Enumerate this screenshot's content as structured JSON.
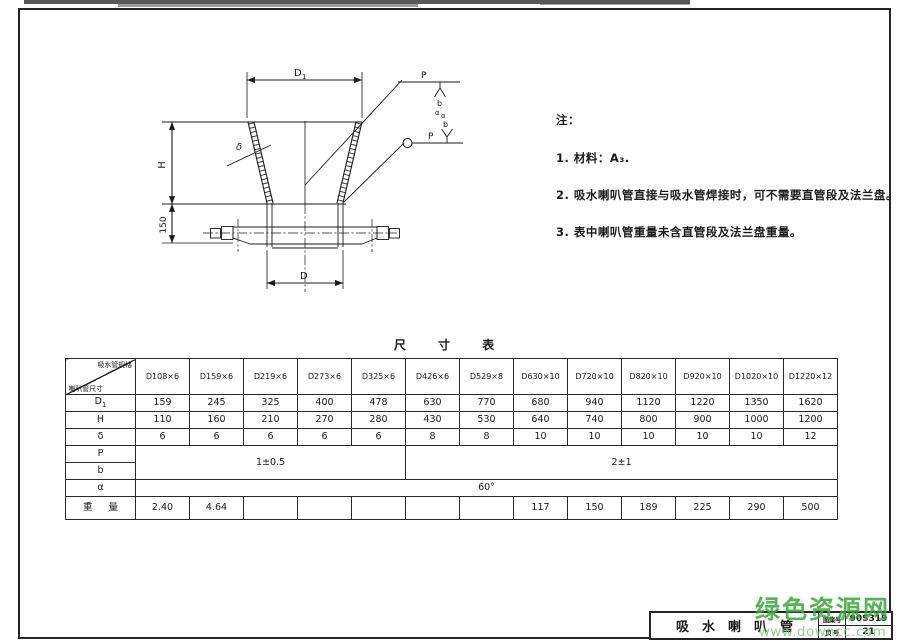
{
  "sheet": {
    "drawing_title": "吸水喇叭管",
    "atlas_label": "图集号",
    "atlas_no": "90S319",
    "page_label": "页 号",
    "page_no": "21"
  },
  "watermark": {
    "line1": "绿色资源网",
    "line2": "www.downcc.com"
  },
  "notes": {
    "heading": "注：",
    "items": [
      "1. 材料：A₃.",
      "2. 吸水喇叭管直接与吸水管焊接时，可不需要直管段及法兰盘。",
      "3. 表中喇叭管重量未含直管段及法兰盘重量。"
    ]
  },
  "drawing": {
    "labels": {
      "d1_main": "D",
      "d1_sub": "1",
      "h": "H",
      "dim150": "150",
      "d": "D",
      "delta": "δ",
      "p1": "P",
      "b1": "b",
      "a1": "α",
      "p2": "P",
      "b2": "b",
      "a2": "α"
    }
  },
  "table": {
    "title": "尺 寸 表",
    "corner_top": "吸水管规格",
    "corner_bottom": "喇叭管尺寸",
    "columns": [
      "D108×6",
      "D159×6",
      "D219×6",
      "D273×6",
      "D325×6",
      "D426×6",
      "D529×8",
      "D630×10",
      "D720×10",
      "D820×10",
      "D920×10",
      "D1020×10",
      "D1220×12"
    ],
    "row_labels": {
      "d1_main": "D",
      "d1_sub": "1",
      "h": "H",
      "delta": "δ",
      "p": "P",
      "b": "b",
      "alpha": "α",
      "weight": "重量"
    },
    "rows": {
      "d1": {
        "values": [
          "159",
          "245",
          "325",
          "400",
          "478",
          "630",
          "770",
          "680",
          "940",
          "1120",
          "1220",
          "1350",
          "1620"
        ]
      },
      "h": {
        "values": [
          "110",
          "160",
          "210",
          "270",
          "280",
          "430",
          "530",
          "640",
          "740",
          "800",
          "900",
          "1000",
          "1200"
        ]
      },
      "delta": {
        "values": [
          "6",
          "6",
          "6",
          "6",
          "6",
          "8",
          "8",
          "10",
          "10",
          "10",
          "10",
          "10",
          "12"
        ]
      },
      "pb_left": "1±0.5",
      "pb_right": "2±1",
      "alpha_value": "60°",
      "weight": {
        "values": [
          "2.40",
          "4.64",
          "",
          "",
          "",
          "",
          "",
          "117",
          "150",
          "189",
          "225",
          "290",
          "500"
        ]
      }
    }
  }
}
